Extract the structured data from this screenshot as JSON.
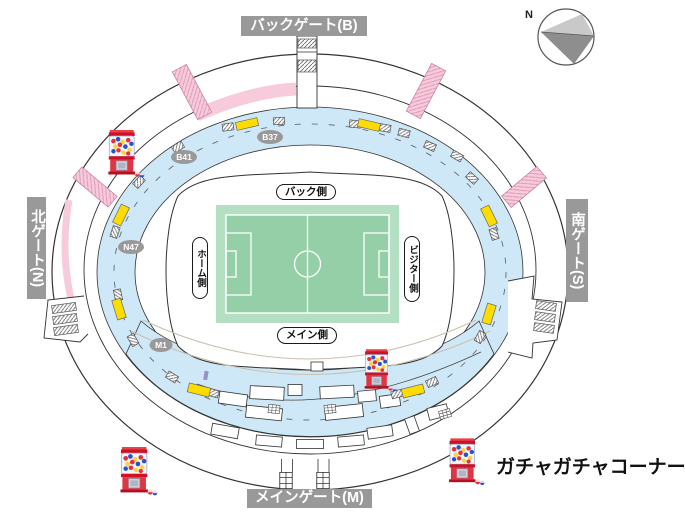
{
  "stadium_map": {
    "gates": {
      "back": "バックゲート(B)",
      "north": "北ゲート(N)",
      "south": "南ゲート(S)",
      "main": "メインゲート(M)"
    },
    "pitch_sides": {
      "back": "バック側",
      "home": "ホーム側",
      "visitor": "ビジター側",
      "main": "メイン側"
    },
    "concourse_badges": {
      "b37": "B37",
      "b41": "B41",
      "n47": "N47",
      "m1": "M1"
    },
    "compass": {
      "north": "N"
    },
    "legend": {
      "gacha_corner": "ガチャガチャコーナー"
    },
    "icons": {
      "gacha_machine": "gacha-machine-icon",
      "compass": "compass-icon",
      "stairs": "stairs-icon"
    },
    "colors": {
      "gate_label_bg": "#999999",
      "badge_bg": "#999999",
      "concourse_blue": "#cfe8f7",
      "pink_stairs": "#f7cbdb",
      "pitch_margin": "#b4dfc3",
      "pitch_field": "#94cfa7",
      "kiosk_yellow": "#ffdc00",
      "outline": "#333333"
    }
  }
}
